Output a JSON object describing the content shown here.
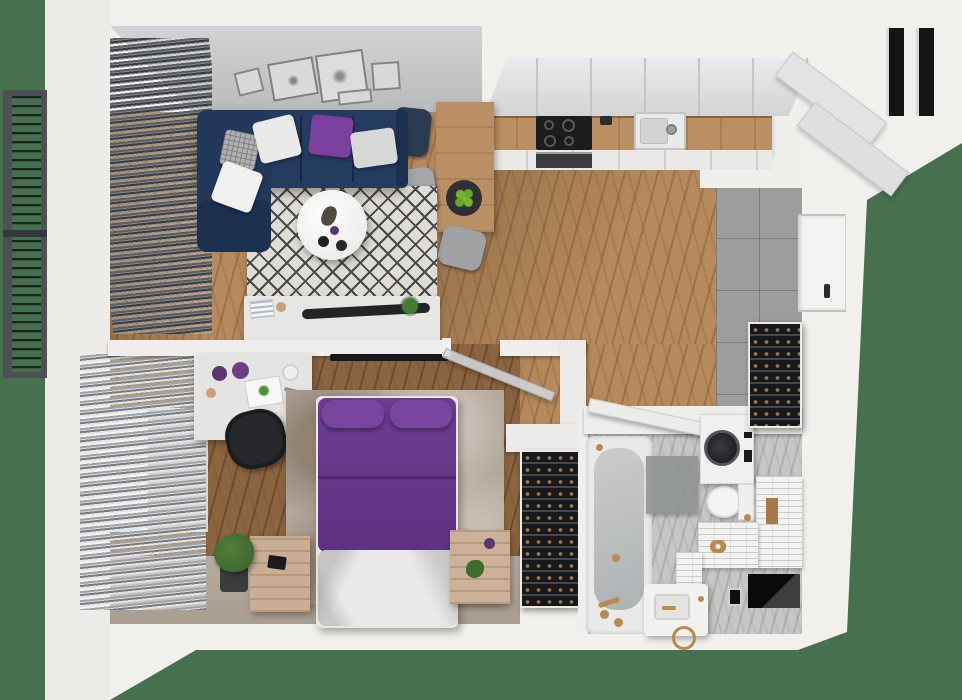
{
  "scene": {
    "kind": "apartment-floor-plan-3d-render",
    "view": "top-down dollhouse cutaway",
    "background_color": "#47704E"
  },
  "colors": {
    "bg_green": "#47704E",
    "wall_white": "#F1F0ED",
    "inner_wall_gray": "#C6C7C9",
    "wood_light": "#B68A5C",
    "wood_dark": "#8A6540",
    "counter_wood": "#B98F63",
    "tile_gray": "#9D9D9B",
    "bath_floor": "#C6C6C4",
    "sofa_navy": "#243C60",
    "sofa_shade": "#1C3050",
    "purple_accent": "#7B3F9D",
    "bed_purple": "#6C3D92",
    "rug_base": "#DFDBD5",
    "rug_line": "#47474A",
    "rug_mottled": "#B3A89C",
    "cabinet_face": "#E2E3E5",
    "appliance_black": "#1B1C1E",
    "rack_black": "#17191C",
    "gold": "#B68B4C",
    "louver_dark": "#4A4D52",
    "louver_light": "#9FA3A7",
    "balcony_rail": "#4D5055",
    "plant_green": "#437B33",
    "doorway_black": "#0B0B0C"
  },
  "rooms": {
    "balcony": {
      "label": "balcony",
      "items": [
        "railing-frame",
        "slatted-floor",
        "cross-rail"
      ]
    },
    "living_room": {
      "label": "living-room",
      "items": [
        "sectional-sofa",
        "throw-pillows",
        "diamond-rug",
        "round-coffee-table",
        "tv-sideboard",
        "wall-art-frames",
        "window-blinds"
      ]
    },
    "kitchen": {
      "label": "kitchen",
      "items": [
        "upper-cabinets",
        "wood-countertop",
        "induction-cooktop",
        "oven",
        "sink",
        "dining-table",
        "dining-chairs",
        "fruit-bowl"
      ]
    },
    "hallway": {
      "label": "entry-hall",
      "items": [
        "gray-tile-floor",
        "storage-rack",
        "entry-door"
      ]
    },
    "bedroom": {
      "label": "bedroom",
      "items": [
        "purple-double-bed",
        "desk",
        "office-chair",
        "nightstands",
        "mottled-rug",
        "wall-tv",
        "floor-plant",
        "shoe-rack",
        "window-blinds"
      ]
    },
    "bathroom": {
      "label": "bathroom",
      "items": [
        "bathtub",
        "washing-machine",
        "toilet",
        "vanity-sink",
        "tiled-bench",
        "bath-mat",
        "gold-fixtures"
      ]
    }
  }
}
